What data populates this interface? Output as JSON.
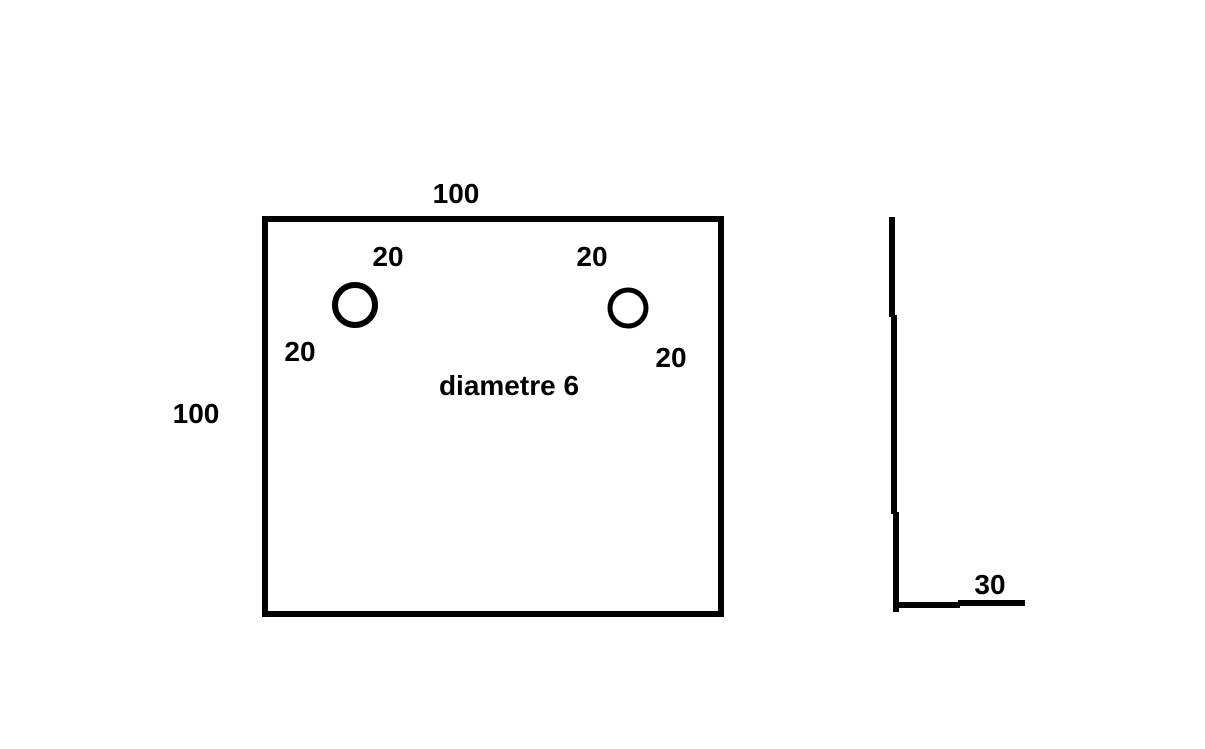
{
  "drawing": {
    "background_color": "#ffffff",
    "ink_color": "#000000",
    "front_view": {
      "width_label": "100",
      "height_label": "100",
      "hole_note": "diametre 6",
      "left_hole": {
        "top_offset_label": "20",
        "side_offset_label": "20"
      },
      "right_hole": {
        "top_offset_label": "20",
        "side_offset_label": "20"
      }
    },
    "side_view": {
      "flange_width_label": "30"
    }
  }
}
